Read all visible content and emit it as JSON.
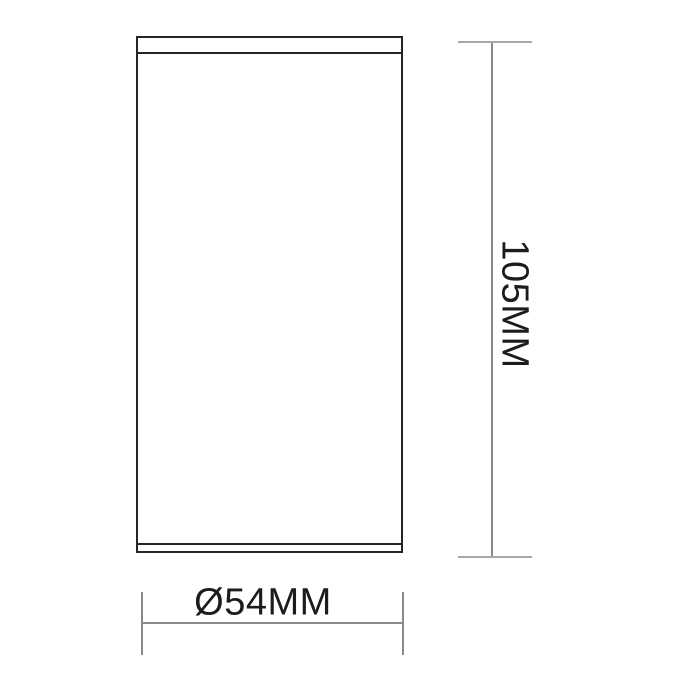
{
  "canvas": {
    "width": 700,
    "height": 700
  },
  "drawing": {
    "type": "technical-dimension-drawing",
    "object": "cylindrical-fixture-side-view",
    "height_dimension": {
      "label": "105MM",
      "orientation": "vertical-right",
      "value_mm": 105
    },
    "diameter_dimension": {
      "label": "Ø54MM",
      "orientation": "horizontal-bottom",
      "value_mm": 54
    }
  },
  "colors": {
    "outline": "#2b2422",
    "dimension_line": "#8a8a8a",
    "tick": "#a8a8a8",
    "text": "#1e1b19",
    "background": "#ffffff"
  }
}
